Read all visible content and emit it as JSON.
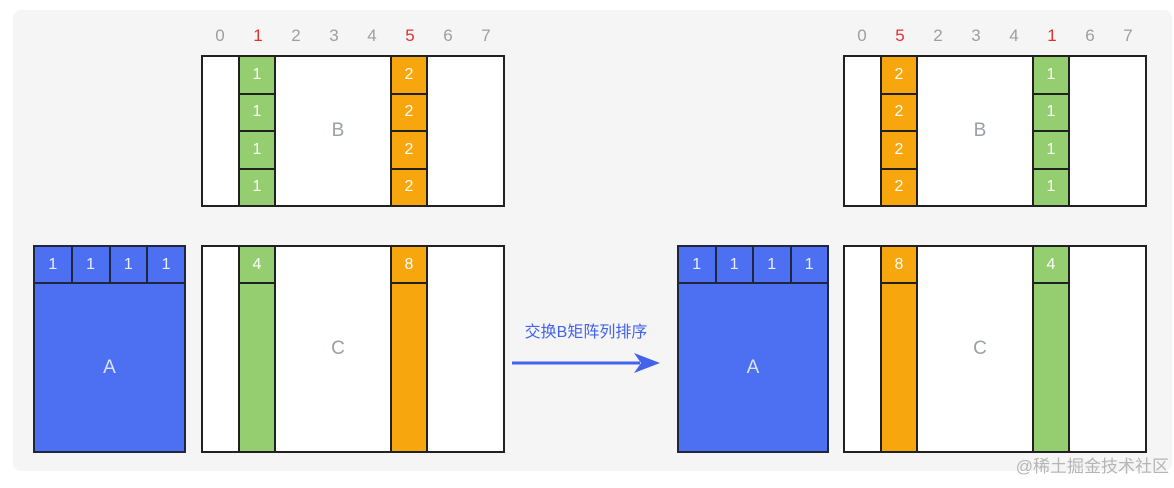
{
  "page": {
    "watermark": "@稀土掘金技术社区"
  },
  "colors": {
    "canvas_bg": "#f5f5f6",
    "green": "#94ce71",
    "orange": "#f7a60d",
    "blue": "#4d6ff2",
    "border": "#212121",
    "index_gray": "#9e9e9e",
    "index_red": "#e03131",
    "label_gray": "#9aa0a6",
    "arrow_blue": "#4263eb",
    "cell_text": "#fdfdf8",
    "watermark_gray": "#b5b5b5"
  },
  "arrow": {
    "label": "交换B矩阵列排序"
  },
  "left": {
    "indices": [
      "0",
      "1",
      "2",
      "3",
      "4",
      "5",
      "6",
      "7"
    ],
    "red_indices": [
      1,
      5
    ],
    "b": {
      "label": "B",
      "columns": [
        {
          "index": 1,
          "color": "green",
          "values": [
            "1",
            "1",
            "1",
            "1"
          ]
        },
        {
          "index": 5,
          "color": "orange",
          "values": [
            "2",
            "2",
            "2",
            "2"
          ]
        }
      ]
    },
    "a": {
      "label": "A",
      "header": [
        "1",
        "1",
        "1",
        "1"
      ]
    },
    "c": {
      "label": "C",
      "columns": [
        {
          "index": 1,
          "color": "green",
          "header": "4"
        },
        {
          "index": 5,
          "color": "orange",
          "header": "8"
        }
      ]
    }
  },
  "right": {
    "indices": [
      "0",
      "5",
      "2",
      "3",
      "4",
      "1",
      "6",
      "7"
    ],
    "red_indices": [
      1,
      5
    ],
    "b": {
      "label": "B",
      "columns": [
        {
          "index": 1,
          "color": "orange",
          "values": [
            "2",
            "2",
            "2",
            "2"
          ]
        },
        {
          "index": 5,
          "color": "green",
          "values": [
            "1",
            "1",
            "1",
            "1"
          ]
        }
      ]
    },
    "a": {
      "label": "A",
      "header": [
        "1",
        "1",
        "1",
        "1"
      ]
    },
    "c": {
      "label": "C",
      "columns": [
        {
          "index": 1,
          "color": "orange",
          "header": "8"
        },
        {
          "index": 5,
          "color": "green",
          "header": "4"
        }
      ]
    }
  }
}
